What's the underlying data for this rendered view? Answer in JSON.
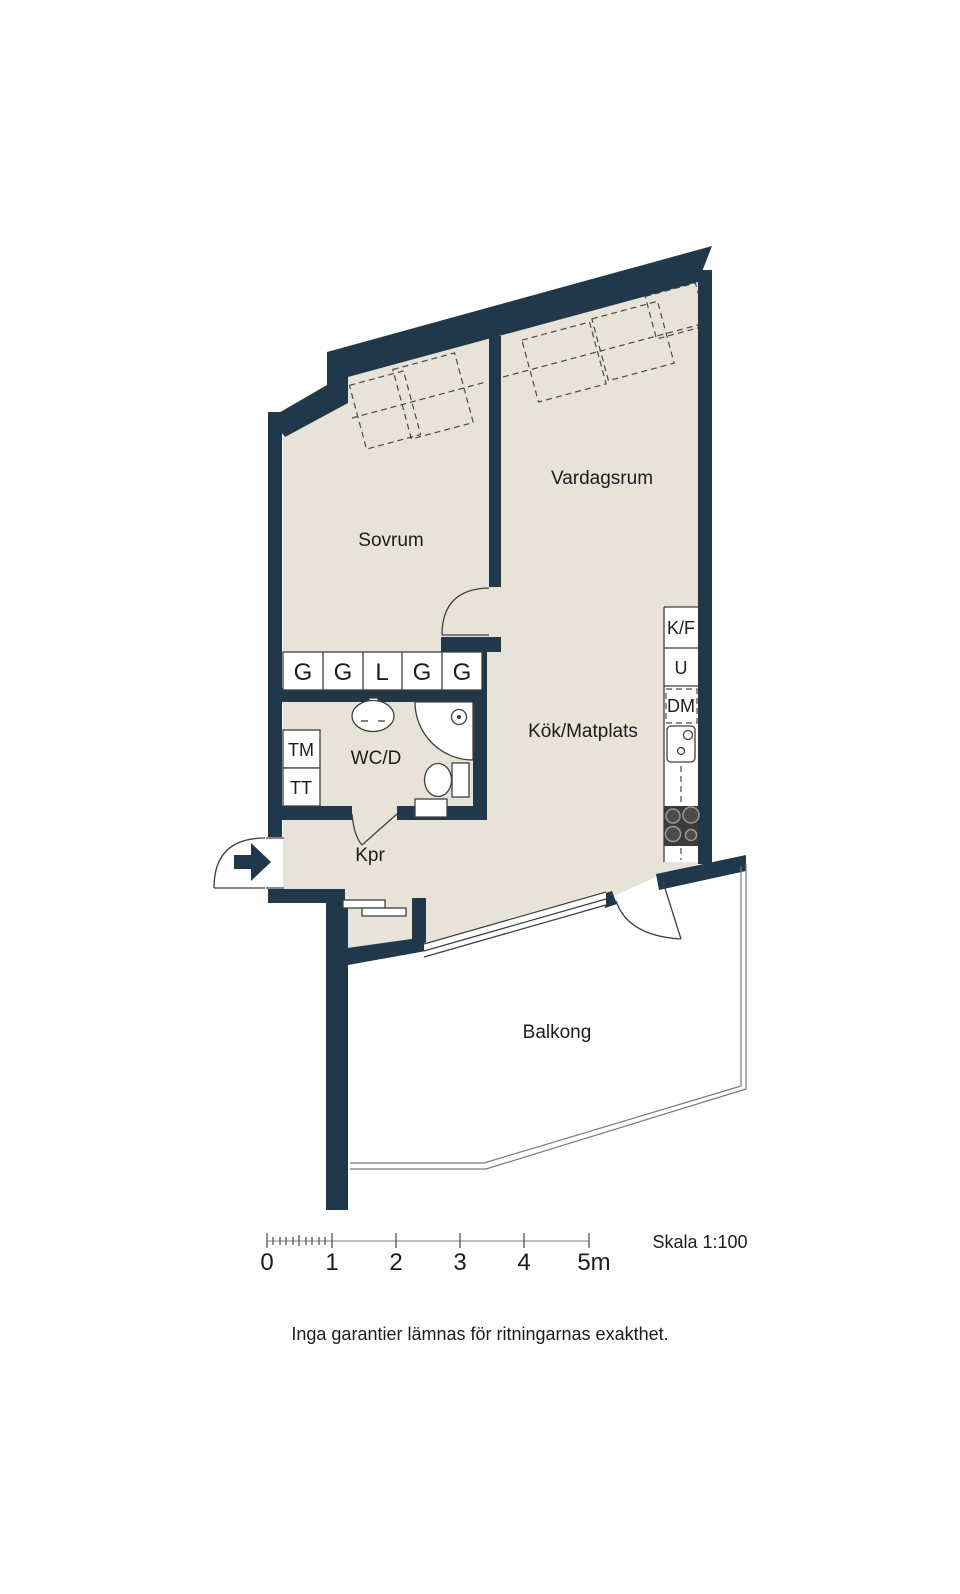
{
  "rooms": {
    "sovrum": "Sovrum",
    "vardagsrum": "Vardagsrum",
    "kok_matplats": "Kök/Matplats",
    "wc_d": "WC/D",
    "kpr": "Kpr",
    "balkong": "Balkong"
  },
  "wardrobes": {
    "cells": [
      "G",
      "G",
      "L",
      "G",
      "G"
    ]
  },
  "laundry": {
    "washer": "TM",
    "dryer": "TT"
  },
  "kitchen": {
    "fridge_freezer": "K/F",
    "oven": "U",
    "dishwasher": "DM"
  },
  "scale_bar": {
    "tick_labels": [
      "0",
      "1",
      "2",
      "3",
      "4",
      "5m"
    ],
    "scale_text": "Skala 1:100"
  },
  "footer": {
    "disclaimer": "Inga garantier lämnas för ritningarnas exakthet."
  },
  "colors": {
    "wall": "#203849",
    "floor": "#e7e3d8"
  }
}
